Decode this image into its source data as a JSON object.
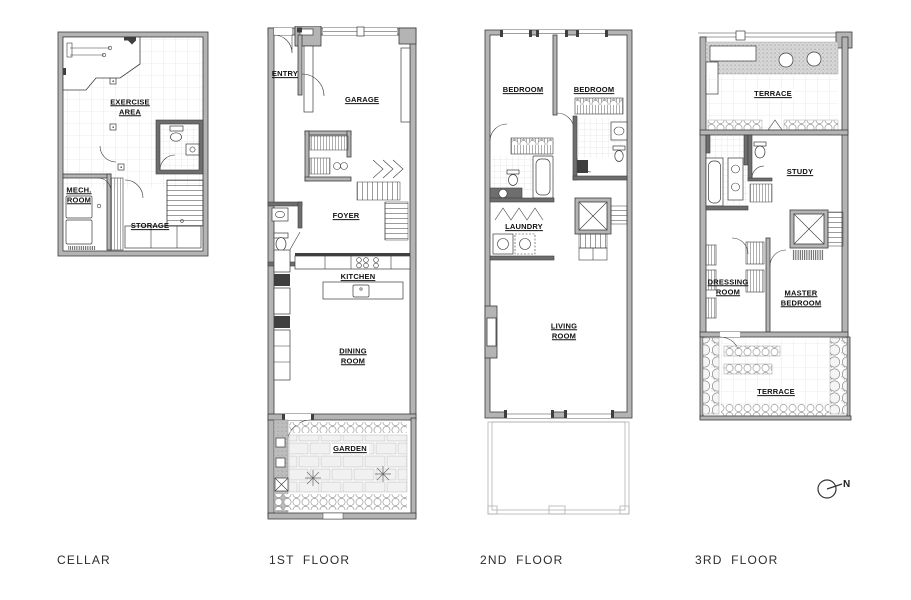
{
  "colors": {
    "wall": "#b4b4b4",
    "wall_dark": "#6e6e6e",
    "line": "#3c3c3c",
    "grid": "#d9d9d9",
    "paper": "#ffffff"
  },
  "plans": {
    "cellar": {
      "caption": "CELLAR",
      "rooms": {
        "exercise": "EXERCISE\nAREA",
        "mech": "MECH.\nROOM",
        "storage": "STORAGE"
      }
    },
    "first": {
      "caption": "1ST FLOOR",
      "rooms": {
        "entry": "ENTRY",
        "garage": "GARAGE",
        "foyer": "FOYER",
        "kitchen": "KITCHEN",
        "dining": "DINING\nROOM",
        "garden": "GARDEN"
      }
    },
    "second": {
      "caption": "2ND FLOOR",
      "rooms": {
        "bedroom_left": "BEDROOM",
        "bedroom_right": "BEDROOM",
        "laundry": "LAUNDRY",
        "living": "LIVING\nROOM"
      }
    },
    "third": {
      "caption": "3RD FLOOR",
      "rooms": {
        "terrace_top": "TERRACE",
        "study": "STUDY",
        "dressing": "DRESSING\nROOM",
        "master": "MASTER\nBEDROOM",
        "terrace_bottom": "TERRACE"
      }
    }
  },
  "compass": {
    "north": "N"
  }
}
